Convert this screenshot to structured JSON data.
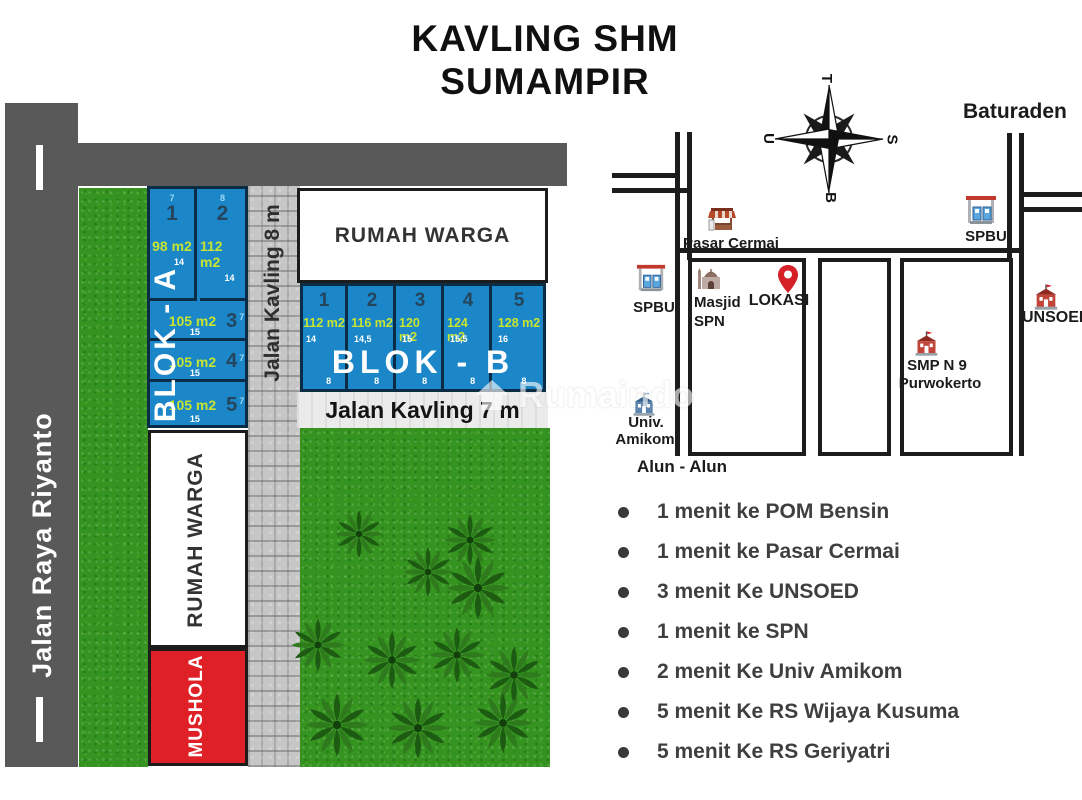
{
  "title": {
    "line1": "KAVLING SHM",
    "line2": "SUMAMPIR"
  },
  "site_plan": {
    "jalan_raya": "Jalan Raya Riyanto",
    "jalan_kavling_8": "Jalan Kavling 8 m",
    "jalan_kavling_7": "Jalan Kavling 7 m",
    "rumah_warga_top": "RUMAH WARGA",
    "rumah_warga_side": "RUMAH WARGA",
    "mushola": "MUSHOLA",
    "blok_a": {
      "label": "BLOK - A",
      "plot1": {
        "no": "1",
        "size": "98 m2",
        "width_m": "7",
        "depth_m": "14"
      },
      "plot2": {
        "no": "2",
        "size": "112 m2",
        "width_m": "8",
        "depth_m": "14"
      },
      "plot3": {
        "no": "3",
        "size": "105 m2",
        "width_m": "7",
        "depth_m": "15"
      },
      "plot4": {
        "no": "4",
        "size": "105 m2",
        "width_m": "7",
        "depth_m": "15"
      },
      "plot5": {
        "no": "5",
        "size": "105 m2",
        "width_m": "7",
        "depth_m": "15"
      }
    },
    "blok_b": {
      "label": "BLOK - B",
      "plot1": {
        "no": "1",
        "size": "112 m2",
        "depth_m": "14",
        "width_m": "8"
      },
      "plot2": {
        "no": "2",
        "size": "116 m2",
        "depth_m": "14,5",
        "width_m": "8"
      },
      "plot3": {
        "no": "3",
        "size": "120 m2",
        "depth_m": "15",
        "width_m": "8"
      },
      "plot4": {
        "no": "4",
        "size": "124 m2",
        "depth_m": "15,5",
        "width_m": "8"
      },
      "plot5": {
        "no": "5",
        "size": "128 m2",
        "depth_m": "16",
        "width_m": "8"
      }
    }
  },
  "map": {
    "compass": {
      "top": "T",
      "left": "U",
      "right": "S",
      "bottom": "B"
    },
    "baturaden": "Baturaden",
    "pasar_cermai": "Pasar Cermai",
    "spbu_right": "SPBU",
    "spbu_left": "SPBU",
    "masjid_line1": "Masjid",
    "masjid_line2": "SPN",
    "lokasi": "LOKASI",
    "smp_line1": "SMP N 9",
    "smp_line2": "Purwokerto",
    "unsoed": "UNSOED",
    "amikom_line1": "Univ.",
    "amikom_line2": "Amikom",
    "alun_alun": "Alun - Alun"
  },
  "poi_list": {
    "items": [
      "1 menit ke POM Bensin",
      "1 menit ke Pasar Cermai",
      "3 menit Ke UNSOED",
      "1 menit ke SPN",
      "2 menit Ke Univ Amikom",
      "5 menit Ke RS Wijaya Kusuma",
      "5 menit Ke RS Geriyatri"
    ]
  },
  "watermark": {
    "text": "Rumaindo"
  },
  "colors": {
    "plot_blue": "#1b87c9",
    "plot_border": "#0b2c45",
    "size_text": "#c6e430",
    "mushola_red": "#df2127",
    "road_gray": "#595959",
    "map_line": "#1c1c1c"
  }
}
